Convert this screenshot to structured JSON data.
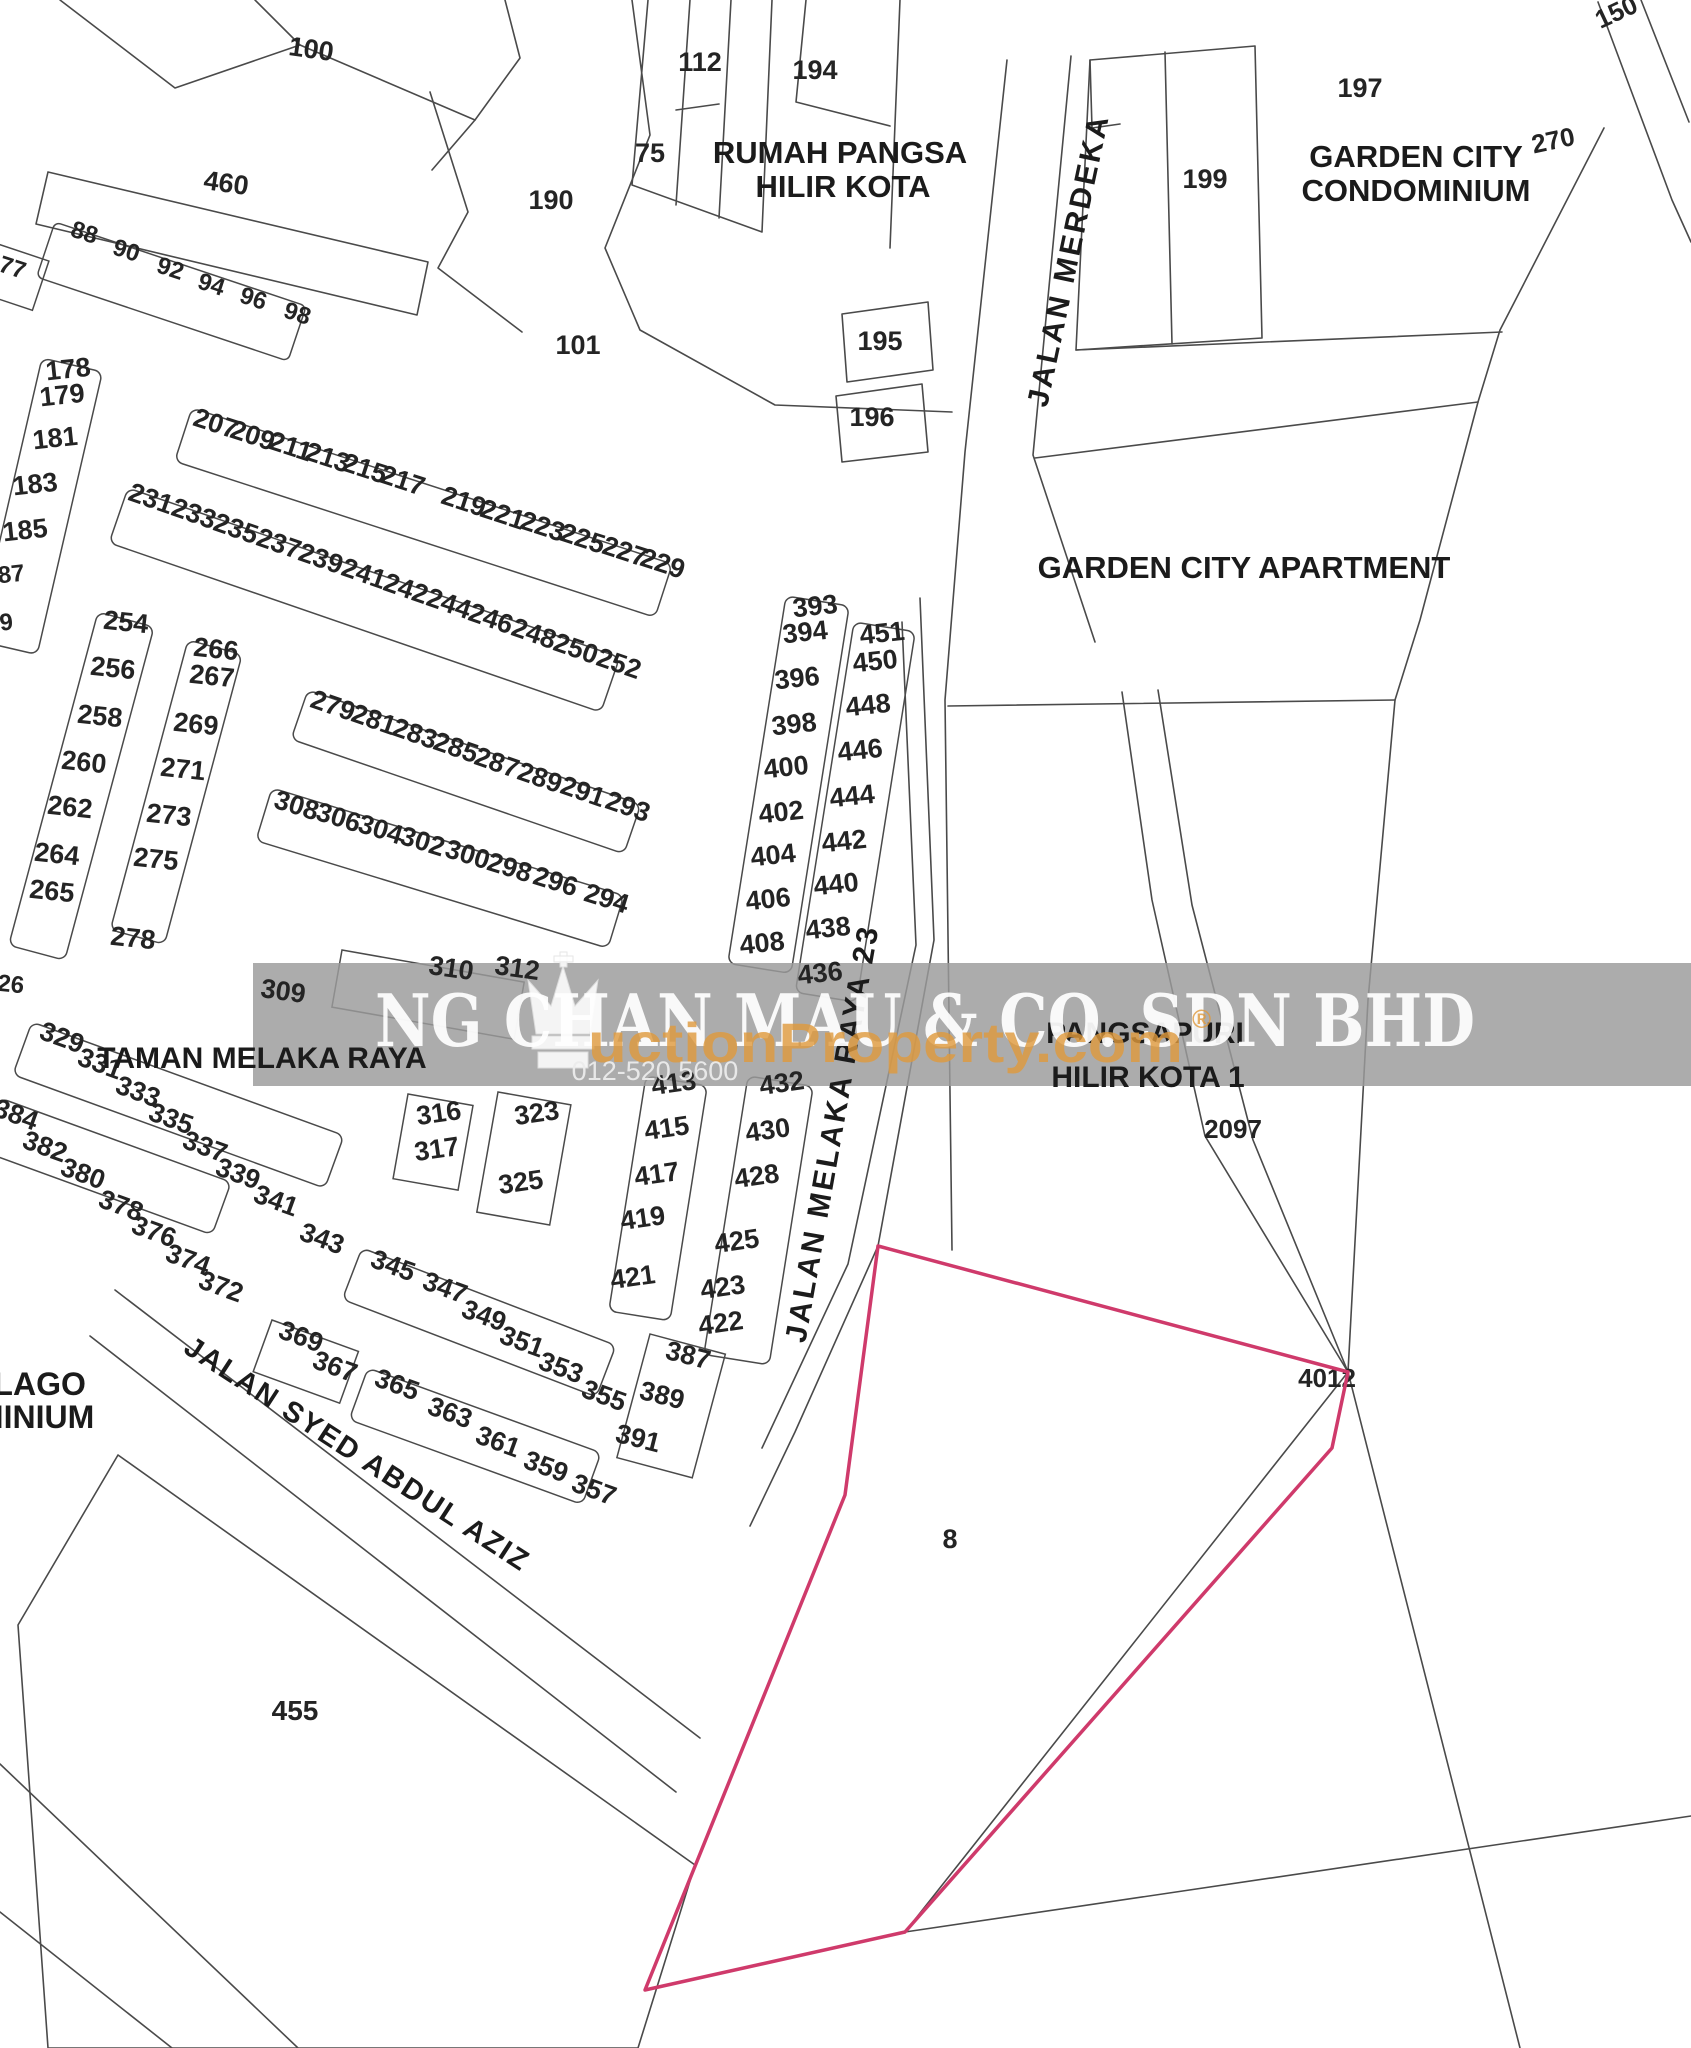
{
  "map": {
    "watermark": {
      "company": "NG CHAN MAU & CO. SDN BHD",
      "portal": "uctionProperty.com",
      "registered": "®",
      "phone": "012-520 5600",
      "band_color": "#9b9b9b",
      "company_color": "#ffffff",
      "portal_color": "#e09a3c"
    },
    "subject_lot": {
      "label": "8",
      "label_x": 950,
      "label_y": 1548,
      "outline_color": "#cf3a6b",
      "points": "878,1246 1348,1372 1332,1448 905,1932 645,1990 845,1495"
    },
    "street_labels": [
      {
        "t": "JALAN MERDEKA",
        "x": 1078,
        "y": 262,
        "r": -78,
        "s": 30,
        "ls": 3
      },
      {
        "t": "JALAN MELAKA RAYA 23",
        "x": 842,
        "y": 1135,
        "r": -80,
        "s": 30,
        "ls": 3
      },
      {
        "t": "JALAN SYED ABDUL AZIZ",
        "x": 352,
        "y": 1462,
        "r": 33,
        "s": 29,
        "ls": 2
      }
    ],
    "area_labels": [
      {
        "t": "RUMAH PANGSA",
        "x": 840,
        "y": 163,
        "s": 31
      },
      {
        "t": "HILIR KOTA",
        "x": 843,
        "y": 197,
        "s": 31
      },
      {
        "t": "GARDEN CITY",
        "x": 1416,
        "y": 167,
        "s": 31
      },
      {
        "t": "CONDOMINIUM",
        "x": 1416,
        "y": 201,
        "s": 31
      },
      {
        "t": "GARDEN CITY APARTMENT",
        "x": 1244,
        "y": 578,
        "s": 31
      },
      {
        "t": "PANGSAPURI",
        "x": 1145,
        "y": 1043,
        "s": 30
      },
      {
        "t": "HILIR KOTA 1",
        "x": 1148,
        "y": 1087,
        "s": 30
      },
      {
        "t": "TAMAN MELAKA RAYA",
        "x": 262,
        "y": 1068,
        "s": 30,
        "a": "start"
      },
      {
        "t": "ASA LAGO",
        "x": 2,
        "y": 1395,
        "s": 32,
        "a": "start"
      },
      {
        "t": "NDOMINIUM",
        "x": 0,
        "y": 1428,
        "s": 32,
        "a": "start"
      }
    ],
    "lot_labels": [
      {
        "t": "100",
        "x": 310,
        "y": 58,
        "r": 8
      },
      {
        "t": "460",
        "x": 225,
        "y": 192,
        "r": 8
      },
      {
        "t": "88",
        "x": 82,
        "y": 240,
        "r": 18,
        "s": 24
      },
      {
        "t": "90",
        "x": 124,
        "y": 258,
        "r": 18,
        "s": 24
      },
      {
        "t": "92",
        "x": 168,
        "y": 276,
        "r": 18,
        "s": 24
      },
      {
        "t": "94",
        "x": 209,
        "y": 292,
        "r": 18,
        "s": 24
      },
      {
        "t": "96",
        "x": 251,
        "y": 306,
        "r": 18,
        "s": 24
      },
      {
        "t": "98",
        "x": 295,
        "y": 321,
        "r": 18,
        "s": 24
      },
      {
        "t": "77",
        "x": 10,
        "y": 275,
        "r": 18,
        "s": 24
      },
      {
        "t": "112",
        "x": 700,
        "y": 71
      },
      {
        "t": "75",
        "x": 650,
        "y": 162
      },
      {
        "t": "190",
        "x": 551,
        "y": 209
      },
      {
        "t": "101",
        "x": 578,
        "y": 354
      },
      {
        "t": "194",
        "x": 815,
        "y": 79
      },
      {
        "t": "195",
        "x": 880,
        "y": 350
      },
      {
        "t": "196",
        "x": 872,
        "y": 426
      },
      {
        "t": "197",
        "x": 1360,
        "y": 97
      },
      {
        "t": "199",
        "x": 1205,
        "y": 188
      },
      {
        "t": "150",
        "x": 1620,
        "y": 20,
        "r": -25,
        "s": 26
      },
      {
        "t": "270",
        "x": 1555,
        "y": 149,
        "r": -12,
        "s": 26
      },
      {
        "t": "178",
        "x": 69,
        "y": 378,
        "r": -6
      },
      {
        "t": "179",
        "x": 63,
        "y": 404,
        "r": -6
      },
      {
        "t": "181",
        "x": 56,
        "y": 447,
        "r": -6
      },
      {
        "t": "183",
        "x": 36,
        "y": 493,
        "r": -6
      },
      {
        "t": "185",
        "x": 26,
        "y": 539,
        "r": -6
      },
      {
        "t": "87",
        "x": 12,
        "y": 582,
        "r": -6,
        "s": 24
      },
      {
        "t": "9",
        "x": 7,
        "y": 630,
        "r": -6,
        "s": 24
      },
      {
        "t": "207",
        "x": 213,
        "y": 432,
        "r": 18
      },
      {
        "t": "209",
        "x": 250,
        "y": 444,
        "r": 18
      },
      {
        "t": "211",
        "x": 288,
        "y": 455,
        "r": 18
      },
      {
        "t": "213",
        "x": 325,
        "y": 466,
        "r": 18
      },
      {
        "t": "215",
        "x": 362,
        "y": 477,
        "r": 18
      },
      {
        "t": "217",
        "x": 400,
        "y": 489,
        "r": 18
      },
      {
        "t": "219",
        "x": 461,
        "y": 510,
        "r": 18
      },
      {
        "t": "221",
        "x": 500,
        "y": 523,
        "r": 18
      },
      {
        "t": "223",
        "x": 540,
        "y": 535,
        "r": 18
      },
      {
        "t": "225",
        "x": 580,
        "y": 547,
        "r": 18
      },
      {
        "t": "227",
        "x": 622,
        "y": 560,
        "r": 18
      },
      {
        "t": "229",
        "x": 660,
        "y": 572,
        "r": 18
      },
      {
        "t": "231",
        "x": 148,
        "y": 507,
        "r": 19
      },
      {
        "t": "233",
        "x": 191,
        "y": 522,
        "r": 19
      },
      {
        "t": "235",
        "x": 233,
        "y": 537,
        "r": 19
      },
      {
        "t": "237",
        "x": 276,
        "y": 552,
        "r": 19
      },
      {
        "t": "239",
        "x": 318,
        "y": 567,
        "r": 19
      },
      {
        "t": "241",
        "x": 361,
        "y": 582,
        "r": 19
      },
      {
        "t": "242",
        "x": 403,
        "y": 597,
        "r": 19
      },
      {
        "t": "244",
        "x": 446,
        "y": 612,
        "r": 19
      },
      {
        "t": "246",
        "x": 488,
        "y": 627,
        "r": 19
      },
      {
        "t": "248",
        "x": 531,
        "y": 642,
        "r": 19
      },
      {
        "t": "250",
        "x": 573,
        "y": 657,
        "r": 19
      },
      {
        "t": "252",
        "x": 616,
        "y": 672,
        "r": 19
      },
      {
        "t": "254",
        "x": 125,
        "y": 631,
        "r": 6
      },
      {
        "t": "256",
        "x": 112,
        "y": 677,
        "r": 6
      },
      {
        "t": "258",
        "x": 99,
        "y": 725,
        "r": 6
      },
      {
        "t": "260",
        "x": 83,
        "y": 771,
        "r": 6
      },
      {
        "t": "262",
        "x": 69,
        "y": 816,
        "r": 6
      },
      {
        "t": "264",
        "x": 56,
        "y": 863,
        "r": 6
      },
      {
        "t": "265",
        "x": 51,
        "y": 900,
        "r": 6
      },
      {
        "t": "278",
        "x": 132,
        "y": 947,
        "r": 6
      },
      {
        "t": "266",
        "x": 215,
        "y": 658,
        "r": 6
      },
      {
        "t": "267",
        "x": 211,
        "y": 685,
        "r": 6
      },
      {
        "t": "269",
        "x": 195,
        "y": 733,
        "r": 6
      },
      {
        "t": "271",
        "x": 182,
        "y": 778,
        "r": 6
      },
      {
        "t": "273",
        "x": 168,
        "y": 824,
        "r": 6
      },
      {
        "t": "275",
        "x": 155,
        "y": 868,
        "r": 6
      },
      {
        "t": "26",
        "x": 10,
        "y": 992,
        "r": 6,
        "s": 24
      },
      {
        "t": "279",
        "x": 330,
        "y": 714,
        "r": 19
      },
      {
        "t": "281",
        "x": 371,
        "y": 728,
        "r": 19
      },
      {
        "t": "283",
        "x": 412,
        "y": 742,
        "r": 19
      },
      {
        "t": "285",
        "x": 453,
        "y": 756,
        "r": 19
      },
      {
        "t": "287",
        "x": 494,
        "y": 771,
        "r": 19
      },
      {
        "t": "289",
        "x": 537,
        "y": 786,
        "r": 19
      },
      {
        "t": "291",
        "x": 580,
        "y": 800,
        "r": 19
      },
      {
        "t": "293",
        "x": 625,
        "y": 815,
        "r": 19
      },
      {
        "t": "308",
        "x": 294,
        "y": 814,
        "r": 17
      },
      {
        "t": "306",
        "x": 336,
        "y": 826,
        "r": 17
      },
      {
        "t": "304",
        "x": 378,
        "y": 838,
        "r": 17
      },
      {
        "t": "302",
        "x": 420,
        "y": 850,
        "r": 17
      },
      {
        "t": "300",
        "x": 465,
        "y": 863,
        "r": 17
      },
      {
        "t": "298",
        "x": 507,
        "y": 876,
        "r": 17
      },
      {
        "t": "296",
        "x": 553,
        "y": 890,
        "r": 17
      },
      {
        "t": "294",
        "x": 604,
        "y": 907,
        "r": 17
      },
      {
        "t": "309",
        "x": 282,
        "y": 1000,
        "r": 8
      },
      {
        "t": "310",
        "x": 450,
        "y": 977,
        "r": 8
      },
      {
        "t": "312",
        "x": 516,
        "y": 977,
        "r": 8
      },
      {
        "t": "393",
        "x": 816,
        "y": 615,
        "r": -6
      },
      {
        "t": "394",
        "x": 806,
        "y": 641,
        "r": -6
      },
      {
        "t": "396",
        "x": 798,
        "y": 687,
        "r": -6
      },
      {
        "t": "398",
        "x": 795,
        "y": 733,
        "r": -6
      },
      {
        "t": "400",
        "x": 787,
        "y": 776,
        "r": -6
      },
      {
        "t": "402",
        "x": 782,
        "y": 821,
        "r": -6
      },
      {
        "t": "404",
        "x": 774,
        "y": 864,
        "r": -6
      },
      {
        "t": "406",
        "x": 769,
        "y": 908,
        "r": -6
      },
      {
        "t": "408",
        "x": 763,
        "y": 952,
        "r": -6
      },
      {
        "t": "451",
        "x": 883,
        "y": 642,
        "r": -6
      },
      {
        "t": "450",
        "x": 876,
        "y": 670,
        "r": -6
      },
      {
        "t": "448",
        "x": 869,
        "y": 714,
        "r": -6
      },
      {
        "t": "446",
        "x": 861,
        "y": 759,
        "r": -6
      },
      {
        "t": "444",
        "x": 853,
        "y": 805,
        "r": -6
      },
      {
        "t": "442",
        "x": 845,
        "y": 850,
        "r": -6
      },
      {
        "t": "440",
        "x": 837,
        "y": 893,
        "r": -6
      },
      {
        "t": "438",
        "x": 829,
        "y": 937,
        "r": -6
      },
      {
        "t": "436",
        "x": 821,
        "y": 982,
        "r": -6
      },
      {
        "t": "413",
        "x": 675,
        "y": 1092,
        "r": -8
      },
      {
        "t": "415",
        "x": 668,
        "y": 1137,
        "r": -8
      },
      {
        "t": "417",
        "x": 658,
        "y": 1183,
        "r": -8
      },
      {
        "t": "419",
        "x": 644,
        "y": 1227,
        "r": -8
      },
      {
        "t": "421",
        "x": 634,
        "y": 1286,
        "r": -8
      },
      {
        "t": "432",
        "x": 783,
        "y": 1092,
        "r": -8
      },
      {
        "t": "430",
        "x": 769,
        "y": 1139,
        "r": -8
      },
      {
        "t": "428",
        "x": 758,
        "y": 1185,
        "r": -8
      },
      {
        "t": "425",
        "x": 738,
        "y": 1250,
        "r": -8
      },
      {
        "t": "423",
        "x": 724,
        "y": 1296,
        "r": -8
      },
      {
        "t": "422",
        "x": 722,
        "y": 1332,
        "r": -8
      },
      {
        "t": "316",
        "x": 440,
        "y": 1122,
        "r": -8
      },
      {
        "t": "317",
        "x": 438,
        "y": 1158,
        "r": -8
      },
      {
        "t": "323",
        "x": 538,
        "y": 1122,
        "r": -8
      },
      {
        "t": "325",
        "x": 522,
        "y": 1191,
        "r": -8
      },
      {
        "t": "329",
        "x": 59,
        "y": 1046,
        "r": 20
      },
      {
        "t": "331",
        "x": 97,
        "y": 1072,
        "r": 20
      },
      {
        "t": "333",
        "x": 135,
        "y": 1100,
        "r": 20
      },
      {
        "t": "335",
        "x": 168,
        "y": 1127,
        "r": 20
      },
      {
        "t": "337",
        "x": 202,
        "y": 1155,
        "r": 20
      },
      {
        "t": "339",
        "x": 235,
        "y": 1182,
        "r": 20
      },
      {
        "t": "341",
        "x": 273,
        "y": 1209,
        "r": 20
      },
      {
        "t": "343",
        "x": 319,
        "y": 1247,
        "r": 20
      },
      {
        "t": "345",
        "x": 390,
        "y": 1274,
        "r": 20
      },
      {
        "t": "347",
        "x": 442,
        "y": 1296,
        "r": 20
      },
      {
        "t": "349",
        "x": 481,
        "y": 1324,
        "r": 20
      },
      {
        "t": "351",
        "x": 519,
        "y": 1350,
        "r": 20
      },
      {
        "t": "353",
        "x": 558,
        "y": 1376,
        "r": 20
      },
      {
        "t": "355",
        "x": 601,
        "y": 1404,
        "r": 20
      },
      {
        "t": "384",
        "x": 13,
        "y": 1123,
        "r": 20
      },
      {
        "t": "382",
        "x": 42,
        "y": 1155,
        "r": 20
      },
      {
        "t": "380",
        "x": 80,
        "y": 1182,
        "r": 20
      },
      {
        "t": "378",
        "x": 118,
        "y": 1214,
        "r": 20
      },
      {
        "t": "376",
        "x": 151,
        "y": 1240,
        "r": 20
      },
      {
        "t": "374",
        "x": 185,
        "y": 1268,
        "r": 20
      },
      {
        "t": "372",
        "x": 218,
        "y": 1295,
        "r": 20
      },
      {
        "t": "365",
        "x": 394,
        "y": 1393,
        "r": 20
      },
      {
        "t": "363",
        "x": 447,
        "y": 1421,
        "r": 20
      },
      {
        "t": "361",
        "x": 495,
        "y": 1450,
        "r": 20
      },
      {
        "t": "359",
        "x": 543,
        "y": 1475,
        "r": 20
      },
      {
        "t": "357",
        "x": 591,
        "y": 1498,
        "r": 20
      },
      {
        "t": "369",
        "x": 298,
        "y": 1345,
        "r": 20
      },
      {
        "t": "367",
        "x": 332,
        "y": 1375,
        "r": 20
      },
      {
        "t": "387",
        "x": 686,
        "y": 1364,
        "r": 14
      },
      {
        "t": "389",
        "x": 660,
        "y": 1404,
        "r": 14
      },
      {
        "t": "391",
        "x": 636,
        "y": 1447,
        "r": 14
      },
      {
        "t": "455",
        "x": 295,
        "y": 1720,
        "s": 28
      },
      {
        "t": "2097",
        "x": 1233,
        "y": 1138,
        "s": 26
      },
      {
        "t": "4012",
        "x": 1327,
        "y": 1387,
        "s": 26
      }
    ]
  }
}
